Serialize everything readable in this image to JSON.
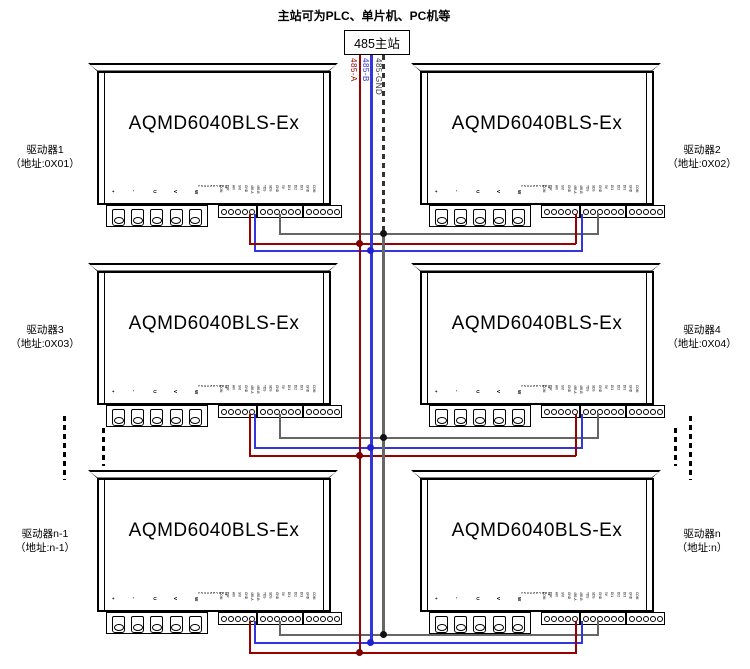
{
  "diagram_title": "主站可为PLC、单片机、PC机等",
  "master_station": {
    "label": "485主站"
  },
  "bus_wires": [
    {
      "label": "485-A",
      "color": "#990000"
    },
    {
      "label": "485-B",
      "color": "#3535e0"
    },
    {
      "label": "485-GND",
      "color": "#666666"
    }
  ],
  "module": {
    "model": "AQMD6040BLS-Ex",
    "power_pins": [
      "+",
      "-",
      "U",
      "V",
      "W"
    ],
    "dip_pins": [
      "1",
      "2",
      "3",
      "4",
      "5",
      "6",
      "7",
      "8",
      "9",
      "10"
    ],
    "signal_groups": [
      [
        "COM",
        "DIR",
        "AVI",
        "SVI",
        "GND"
      ],
      [
        "485-A",
        "485-B",
        "TDS",
        "SDS",
        "GND",
        "5V"
      ],
      [
        "DI1",
        "DI2",
        "DI3",
        "GND",
        "COM"
      ]
    ]
  },
  "drivers": [
    {
      "name": "驱动器1",
      "address": "（地址:0X01）"
    },
    {
      "name": "驱动器2",
      "address": "（地址:0X02）"
    },
    {
      "name": "驱动器3",
      "address": "（地址:0X03）"
    },
    {
      "name": "驱动器4",
      "address": "（地址:0X04）"
    },
    {
      "name": "驱动器n-1",
      "address": "（地址:n-1）"
    },
    {
      "name": "驱动器n",
      "address": "（地址:n）"
    }
  ]
}
